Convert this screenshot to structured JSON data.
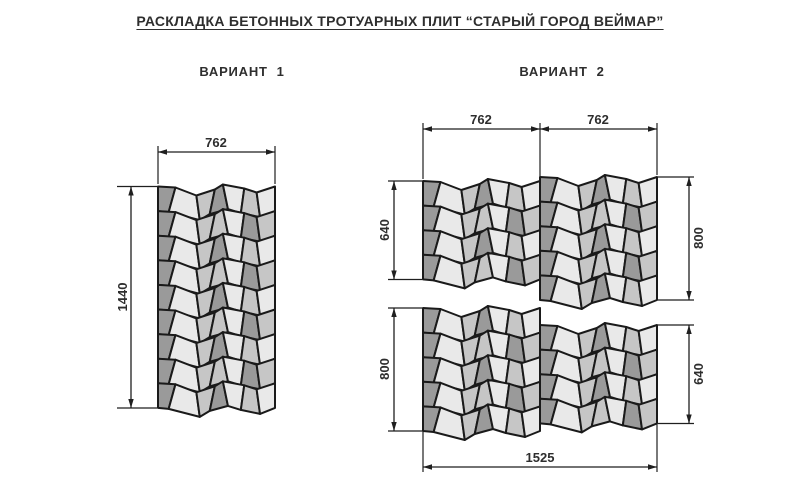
{
  "title": "РАСКЛАДКА БЕТОННЫХ ТРОТУАРНЫХ ПЛИТ “СТАРЫЙ ГОРОД ВЕЙМАР”",
  "variants": {
    "v1": {
      "label": "ВАРИАНТ  1",
      "width_mm": "762",
      "height_mm": "1440"
    },
    "v2": {
      "label": "ВАРИАНТ  2",
      "module_widths_mm": [
        "762",
        "762"
      ],
      "left_heights_mm": [
        "640",
        "800"
      ],
      "right_heights_mm": [
        "800",
        "640"
      ],
      "total_width_mm": "1525"
    }
  },
  "colors": {
    "background": "#ffffff",
    "tile_palette": [
      "#9a9a9a",
      "#e9e9e9",
      "#c6c6c6"
    ],
    "tile_outline": "#1a1a1a",
    "dimension_line": "#1f1f1f",
    "text": "#2e2e2e"
  },
  "pattern": {
    "module_width": 117,
    "row_height": 24.6,
    "boundaries": [
      0,
      0.115,
      0.345,
      0.46,
      0.58,
      0.72,
      0.86,
      1
    ],
    "wave_dy": [
      0,
      1,
      9,
      3,
      -2,
      2,
      6,
      0
    ],
    "tilt": [
      0,
      4,
      -2,
      3,
      -3,
      2,
      -2,
      0
    ],
    "color_rows": [
      [
        0,
        1,
        2,
        0,
        1,
        2,
        1
      ],
      [
        0,
        1,
        2,
        2,
        1,
        0,
        2
      ]
    ]
  },
  "blocks": [
    {
      "name": "variant1-panel",
      "x": 158,
      "y": 186.5,
      "rows": 9
    },
    {
      "name": "variant2-upper-left-panel",
      "x": 423,
      "y": 181,
      "rows": 4
    },
    {
      "name": "variant2-upper-right-panel",
      "x": 540,
      "y": 177,
      "rows": 5
    },
    {
      "name": "variant2-lower-left-panel",
      "x": 423,
      "y": 308,
      "rows": 5
    },
    {
      "name": "variant2-lower-right-panel",
      "x": 540,
      "y": 325,
      "rows": 4
    }
  ],
  "dimensions": [
    {
      "name": "v1-width-dim",
      "label": "762",
      "type": "h",
      "y": 152,
      "x1": 158,
      "x2": 275,
      "lx": 216,
      "ly": 147,
      "ext": [
        [
          158,
          146,
          158,
          184
        ],
        [
          275,
          146,
          275,
          184
        ]
      ]
    },
    {
      "name": "v1-height-dim",
      "label": "1440",
      "type": "v",
      "x": 131,
      "y1": 186.5,
      "y2": 408,
      "lx": 127,
      "ly": 297,
      "ext": [
        [
          117,
          186.5,
          157,
          186.5
        ],
        [
          117,
          408,
          157,
          408
        ]
      ]
    },
    {
      "name": "v2-width-left-dim",
      "label": "762",
      "type": "h",
      "y": 129,
      "x1": 423,
      "x2": 540,
      "lx": 481,
      "ly": 124,
      "ext": [
        [
          423,
          123,
          423,
          179
        ],
        [
          540,
          123,
          540,
          176
        ]
      ]
    },
    {
      "name": "v2-width-right-dim",
      "label": "762",
      "type": "h",
      "y": 129,
      "x1": 540,
      "x2": 657,
      "lx": 598,
      "ly": 124,
      "ext": [
        [
          657,
          123,
          657,
          175
        ]
      ]
    },
    {
      "name": "v2-upper-left-height-dim",
      "label": "640",
      "type": "v",
      "x": 394,
      "y1": 181,
      "y2": 279.5,
      "lx": 389,
      "ly": 230,
      "ext": [
        [
          388,
          181,
          422,
          181
        ],
        [
          388,
          279.5,
          422,
          279.5
        ]
      ]
    },
    {
      "name": "v2-upper-right-height-dim",
      "label": "800",
      "type": "v",
      "x": 689,
      "y1": 177,
      "y2": 300,
      "lx": 703,
      "ly": 238,
      "ext": [
        [
          658,
          177,
          694,
          177
        ],
        [
          658,
          300,
          694,
          300
        ]
      ]
    },
    {
      "name": "v2-lower-left-height-dim",
      "label": "800",
      "type": "v",
      "x": 394,
      "y1": 308,
      "y2": 431,
      "lx": 389,
      "ly": 369,
      "ext": [
        [
          388,
          308,
          422,
          308
        ],
        [
          388,
          431,
          422,
          431
        ]
      ]
    },
    {
      "name": "v2-lower-right-height-dim",
      "label": "640",
      "type": "v",
      "x": 689,
      "y1": 325,
      "y2": 423.5,
      "lx": 703,
      "ly": 374,
      "ext": [
        [
          658,
          325,
          694,
          325
        ],
        [
          658,
          423.5,
          694,
          423.5
        ]
      ]
    },
    {
      "name": "v2-total-width-dim",
      "label": "1525",
      "type": "h",
      "y": 467,
      "x1": 423,
      "x2": 657,
      "lx": 540,
      "ly": 462,
      "ext": [
        [
          423,
          431,
          423,
          472
        ],
        [
          657,
          424,
          657,
          472
        ]
      ]
    }
  ]
}
